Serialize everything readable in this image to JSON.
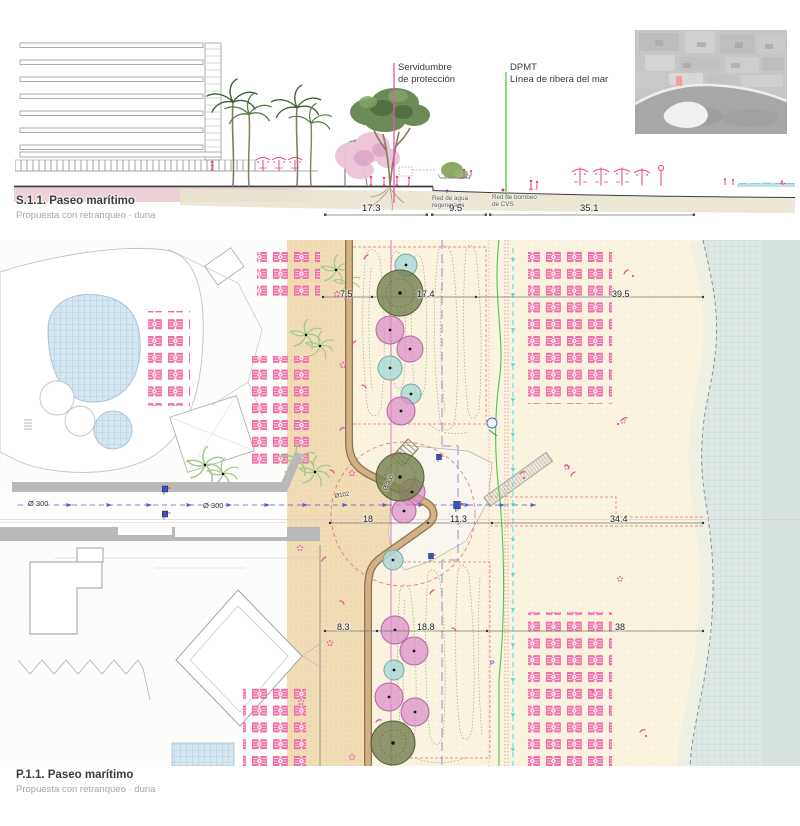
{
  "section": {
    "title": "S.1.1. Paseo marítimo",
    "subtitle": "Propuesta con retranqueo · duna",
    "servidumbre_line1": "Servidumbre",
    "servidumbre_line2": "de protección",
    "dpmt_line1": "DPMT",
    "dpmt_line2": "Línea de ribera del mar",
    "red_agua_line1": "Red de agua",
    "red_agua_line2": "regenerada",
    "red_bombeo_line1": "Red de bombeo",
    "red_bombeo_line2": "de CVS",
    "dims": [
      "17.3",
      "9.5",
      "35.1"
    ]
  },
  "plan": {
    "title": "P.1.1. Paseo marítimo",
    "subtitle": "Propuesta con retranqueo · duna",
    "dims_top": [
      "7.5",
      "17.4",
      "39.5"
    ],
    "dims_mid": [
      "18",
      "11.3",
      "34.4"
    ],
    "dims_bottom": [
      "8.3",
      "18.8",
      "38"
    ],
    "pipe_label_1": "Ø 300",
    "pipe_label_2": "Ø 300",
    "pipe_label_small": "Ø102",
    "tree_diameter_label": "Ø 300",
    "parking_label": "P"
  },
  "colors": {
    "sunbed_pink": "#f26ba4",
    "people_pink": "#e8418c",
    "tree_green": "#76814f",
    "tree_pink": "#dd8ec8",
    "tree_teal": "#aed9d6",
    "servidumbre_magenta": "#e858a8",
    "dpmt_green": "#44cc44",
    "path_tan": "#f0ddb4",
    "sea": "#dee8e5",
    "minimap_marker": "#f5a0a0"
  }
}
